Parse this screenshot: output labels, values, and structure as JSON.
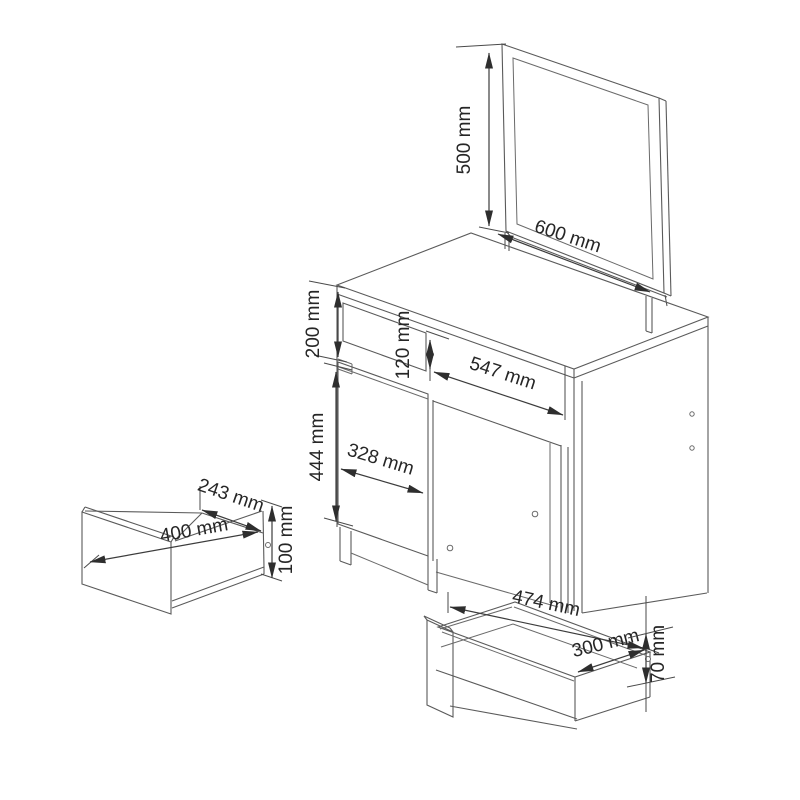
{
  "diagram": {
    "type": "furniture-dimension-diagram",
    "background_color": "#ffffff",
    "line_color": "#5a5a5a",
    "dimension_line_color": "#3c3c3c",
    "label_color": "#262626",
    "mirror": {
      "height": "500 mm",
      "width": "600 mm"
    },
    "desk": {
      "top_section_height": "200 mm",
      "drawer_front_height": "120 mm",
      "kneehole_width": "547 mm",
      "door_height": "444 mm",
      "door_width": "328 mm"
    },
    "side_drawer": {
      "depth": "243 mm",
      "width": "400 mm",
      "height": "100 mm"
    },
    "bottom_drawer": {
      "width": "474 mm",
      "depth": "300 mm",
      "height": "70 mm"
    }
  }
}
